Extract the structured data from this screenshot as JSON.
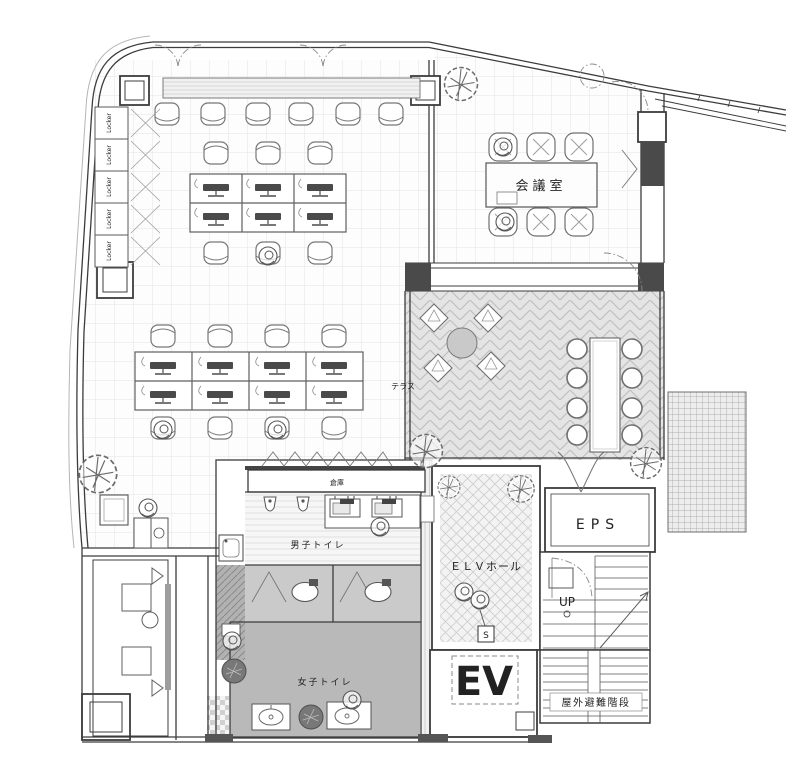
{
  "plan": {
    "title": "office-floor-plan",
    "rooms": {
      "meeting_room": "会議室",
      "terrace": "テラス",
      "storage": "倉庫",
      "mens_toilet": "男子トイレ",
      "womens_toilet": "女子トイレ",
      "elv_hall": "ＥＬＶホール",
      "eps": "EPS",
      "elevator": "EV",
      "stairs_up": "UP",
      "outdoor_stairs": "屋外避難階段",
      "locker": "Locker",
      "switch_box": "S"
    },
    "colors": {
      "background": "#ffffff",
      "wall_line": "#3c3c3c",
      "floor_grid": "#e4e4e6",
      "terrace_floor": "#e4e4e4",
      "womens_floor": "#b9b9b9",
      "stall_floor": "#cacaca",
      "dark_fill": "#4a4a4a",
      "label_text": "#222222"
    }
  }
}
